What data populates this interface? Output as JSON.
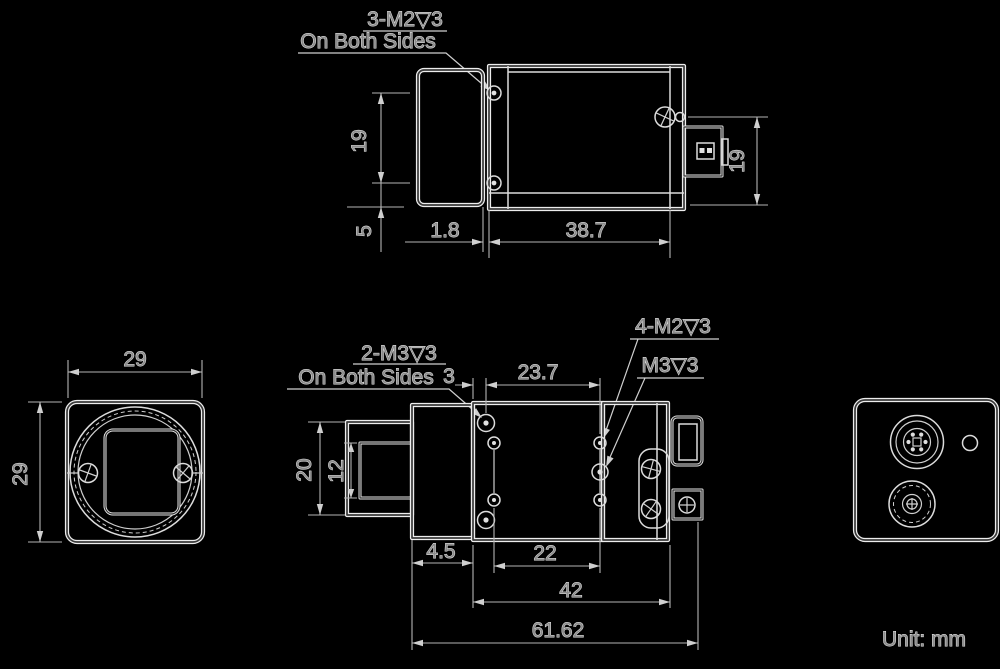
{
  "top_view": {
    "callout": {
      "line1": "3-M2▽3",
      "line2": "On Both Sides"
    },
    "dim_hole_spacing": "19",
    "dim_edge_offset": "5",
    "dim_step": "1.8",
    "dim_body_length": "38.7",
    "dim_side_height": "19"
  },
  "front_view": {
    "dim_width": "29",
    "dim_height": "29"
  },
  "side_view": {
    "callout_m3": {
      "line1": "2-M3▽3",
      "line2": "On Both Sides"
    },
    "callout_m2_rear": "4-M2▽3",
    "callout_m3_rear": "M3▽3",
    "dim_front_offset": "3",
    "dim_top_span": "23.7",
    "dim_barrel": "20",
    "dim_bore": "12",
    "dim_plate": "4.5",
    "dim_bottom_span": "22",
    "dim_mid_span": "42",
    "dim_total": "61.62"
  },
  "footer": {
    "unit_note": "Unit: mm"
  },
  "colors": {
    "background": "#000000",
    "line": "#ededed",
    "dimension": "#b4b4b4"
  }
}
